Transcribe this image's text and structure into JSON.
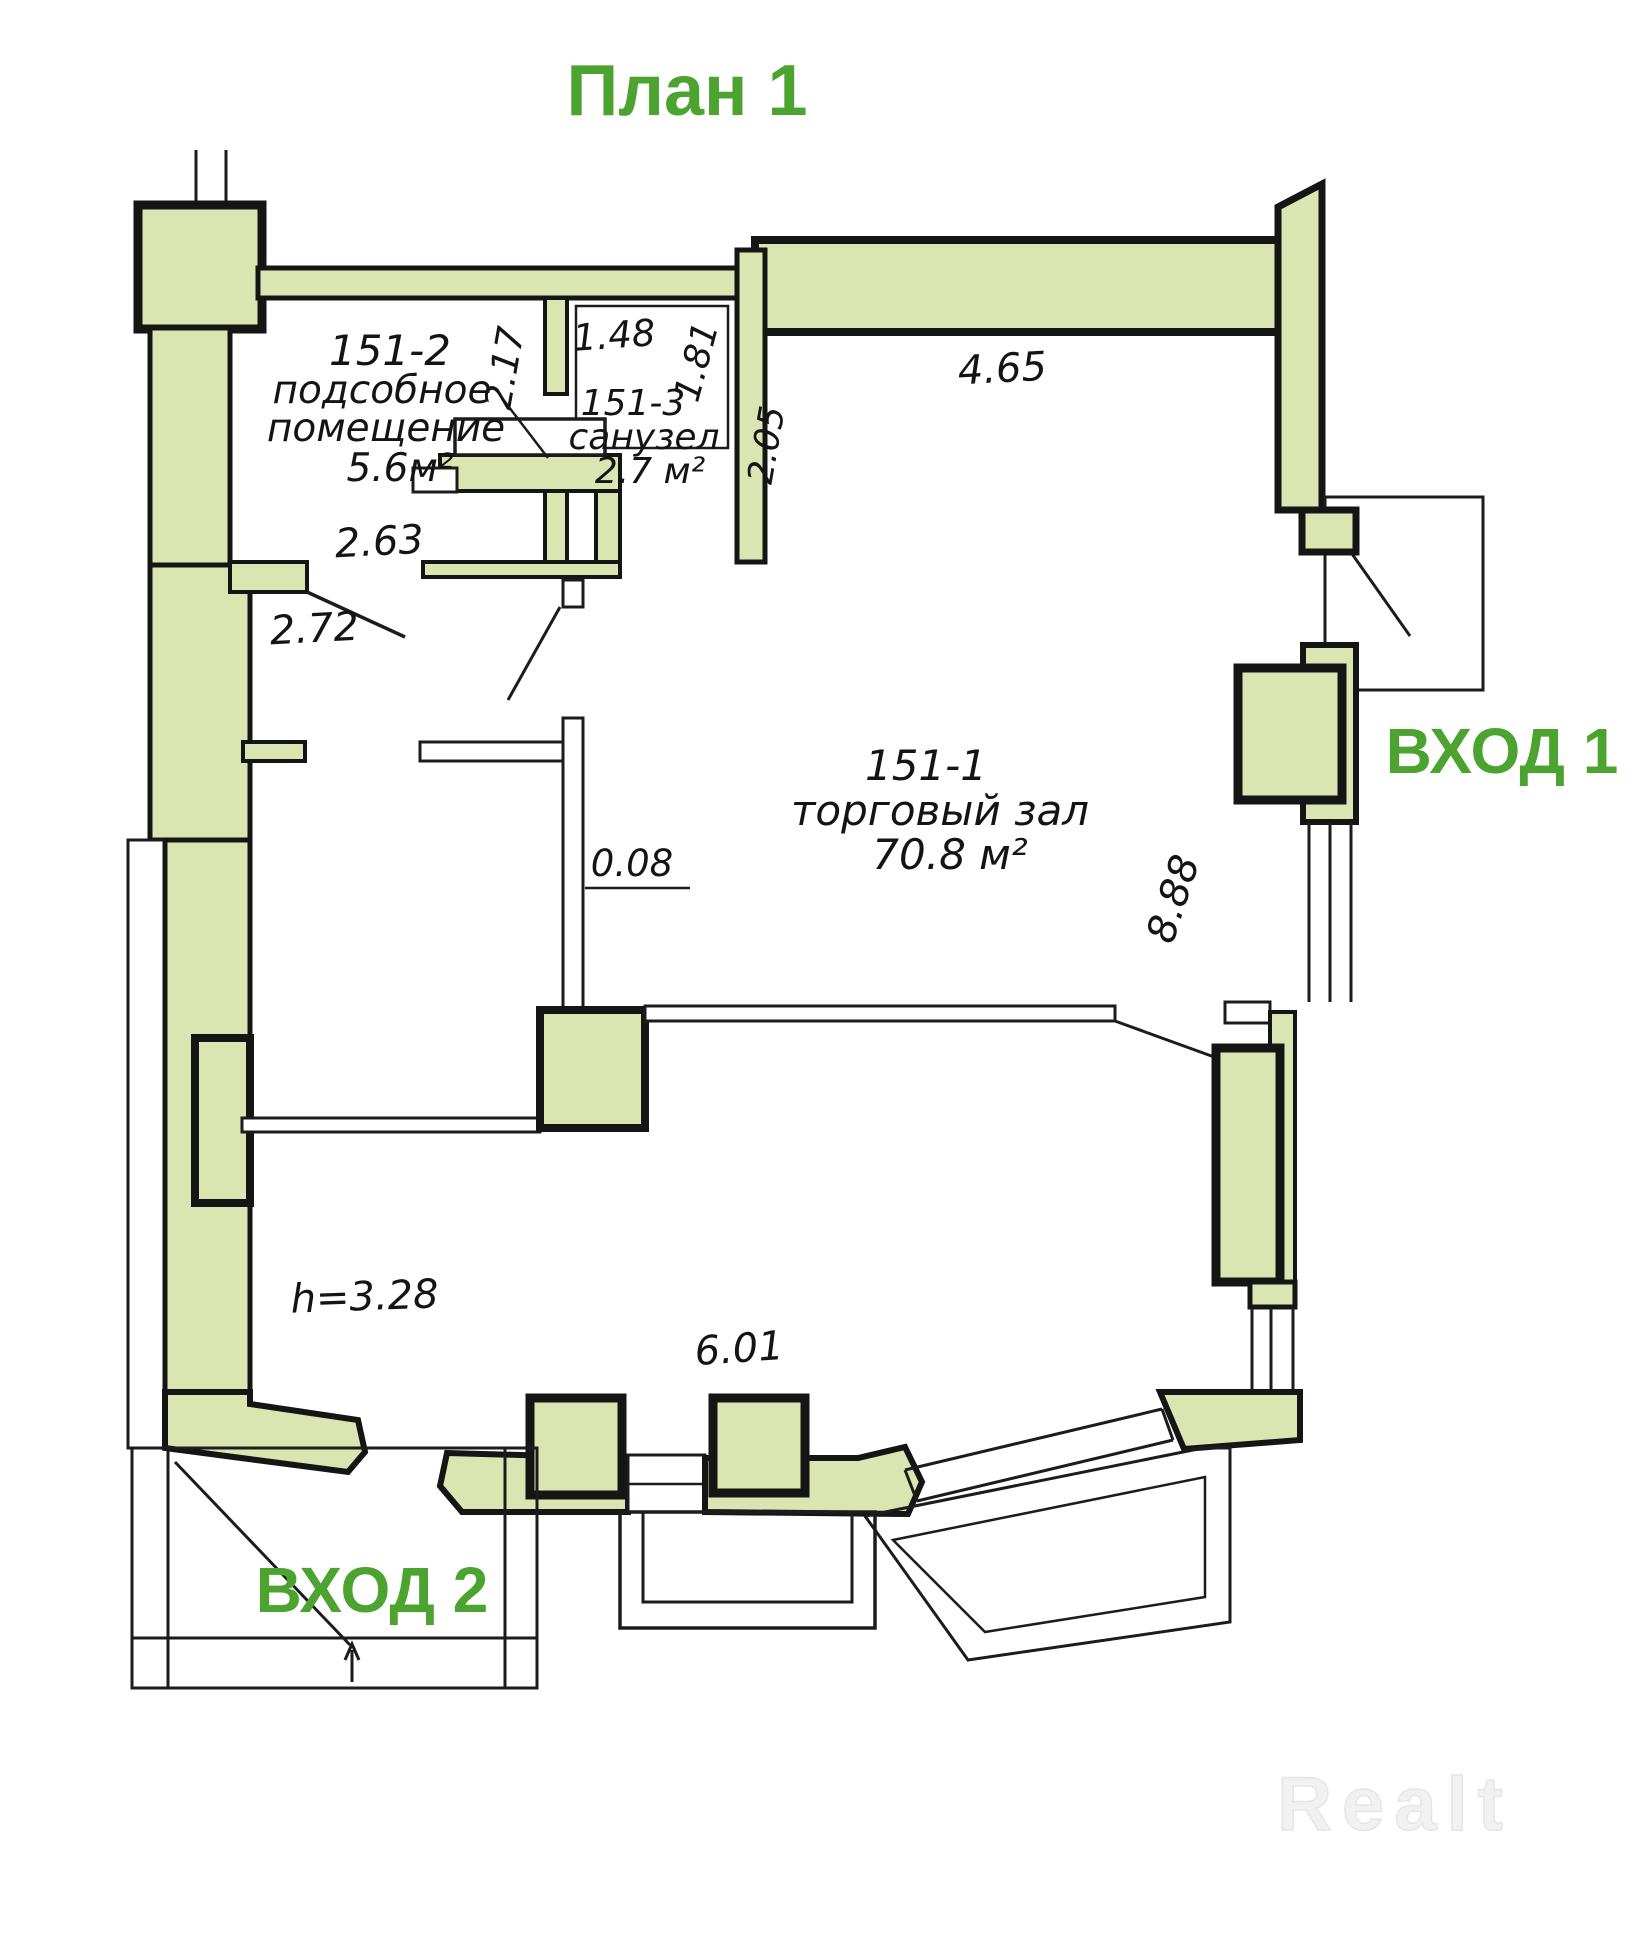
{
  "title": "План 1",
  "watermark": "Realt",
  "colors": {
    "wall_fill": "#dbe5b2",
    "outline": "#151515",
    "accent_green": "#4ca32f",
    "watermark_gray": "#f1f1f1"
  },
  "entrances": {
    "e1": "ВХОД 1",
    "e2": "ВХОД 2"
  },
  "rooms": {
    "hall": {
      "id": "151-1",
      "name": "торговый зал",
      "area": "70.8 м²"
    },
    "utility": {
      "id": "151-2",
      "name_line1": "подсобное",
      "name_line2": "помещение",
      "area": "5.6м²"
    },
    "wc": {
      "id": "151-3",
      "name": "санузел",
      "area": "2.7 м²"
    }
  },
  "dims": {
    "d148": "1.48",
    "d181": "1.81",
    "d217": "2.17",
    "d205": "2.05",
    "d465": "4.65",
    "d263": "2.63",
    "d272": "2.72",
    "d008": "0.08",
    "d888": "8.88",
    "d601": "6.01",
    "ceiling": "h=3.28"
  }
}
